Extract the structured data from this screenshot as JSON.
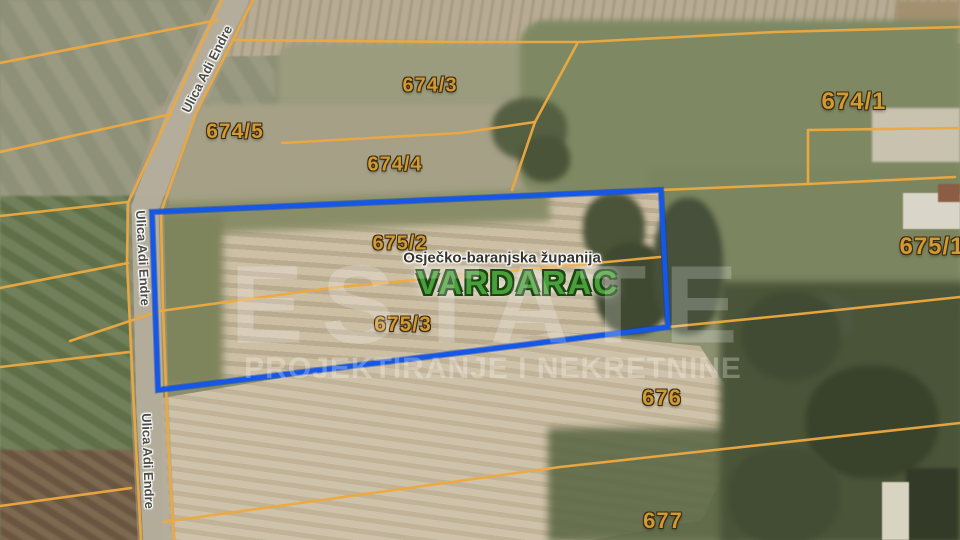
{
  "map": {
    "place_label": {
      "text": "VARDARAC",
      "x": 518,
      "y": 283
    },
    "region_label": {
      "text": "Osječko-baranjska županija",
      "x": 502,
      "y": 258
    },
    "parcel_labels": [
      {
        "text": "674/3",
        "x": 430,
        "y": 86,
        "size": 20
      },
      {
        "text": "674/5",
        "x": 235,
        "y": 132,
        "size": 21
      },
      {
        "text": "674/4",
        "x": 395,
        "y": 165,
        "size": 20
      },
      {
        "text": "674/1",
        "x": 854,
        "y": 102,
        "size": 24
      },
      {
        "text": "675/2",
        "x": 400,
        "y": 244,
        "size": 20
      },
      {
        "text": "675/3",
        "x": 403,
        "y": 325,
        "size": 21
      },
      {
        "text": "675/1",
        "x": 932,
        "y": 247,
        "size": 24
      },
      {
        "text": "676",
        "x": 662,
        "y": 398,
        "size": 22
      },
      {
        "text": "677",
        "x": 663,
        "y": 521,
        "size": 22
      }
    ],
    "street_labels": [
      {
        "text": "Ulica Adi Endre",
        "x": 207,
        "y": 69,
        "angle": -63
      },
      {
        "text": "Ulica Adi Endre",
        "x": 143,
        "y": 258,
        "angle": 87
      },
      {
        "text": "Ulica Adi Endre",
        "x": 148,
        "y": 461,
        "angle": 88
      }
    ],
    "watermark": {
      "line1": "ESTATE",
      "line2": "PROJEKTIRANJE I NEKRETNINE"
    },
    "highlight_parcel": {
      "points": "152,212 661,190 668,327 158,390",
      "color": "#1557e6"
    },
    "colors": {
      "boundary": "#eda93f",
      "highlight": "#1557e6",
      "parcel_text": "#d29a33",
      "place_text": "#49a03a",
      "road": "#b5ae9c"
    },
    "boundaries": [
      "222,0 196,55 170,113 128,203 127,262 133,390 141,540",
      "253,0 233,40 196,113 161,212 163,310 168,440 174,540",
      "0,63 218,20",
      "0,152 171,114",
      "0,216 128,202",
      "0,288 128,263",
      "0,367 130,352",
      "0,506 131,488",
      "233,40 460,42 583,42 775,32 960,27",
      "282,143 460,133 535,122",
      "535,122 577,44",
      "535,122 512,190",
      "661,190 808,184 955,177",
      "808,184 808,130 960,128",
      "70,341 160,311 330,288 660,257",
      "668,327 790,315 960,297",
      "163,522 560,467 960,423"
    ],
    "road_path": "M237,-6 L181,112 L145,208 L150,410 L157,546"
  }
}
